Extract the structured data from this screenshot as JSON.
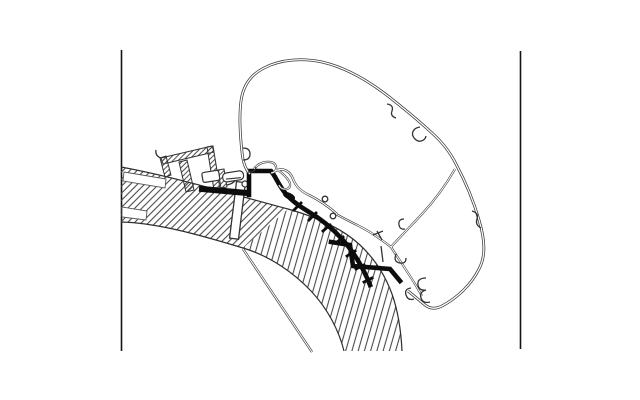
{
  "title": "Awning adapter cross-section technical line drawing",
  "colors": {
    "background": "#ffffff",
    "line": "#3a3a3a",
    "thin": "#333333",
    "bold": "#0d0d0d",
    "hatch": "#4a4a4a",
    "border": "#141414",
    "outline": "#2e2e2e"
  },
  "parts": [
    {
      "label": "awning-cassette-outline"
    },
    {
      "label": "caravan-roof-sandwich-panel"
    },
    {
      "label": "adapter-profile-bold"
    },
    {
      "label": "roof-mounting-rail"
    },
    {
      "label": "fixing-screw"
    },
    {
      "label": "side-wall-line"
    },
    {
      "label": "drip-edge-wave-profile"
    }
  ]
}
